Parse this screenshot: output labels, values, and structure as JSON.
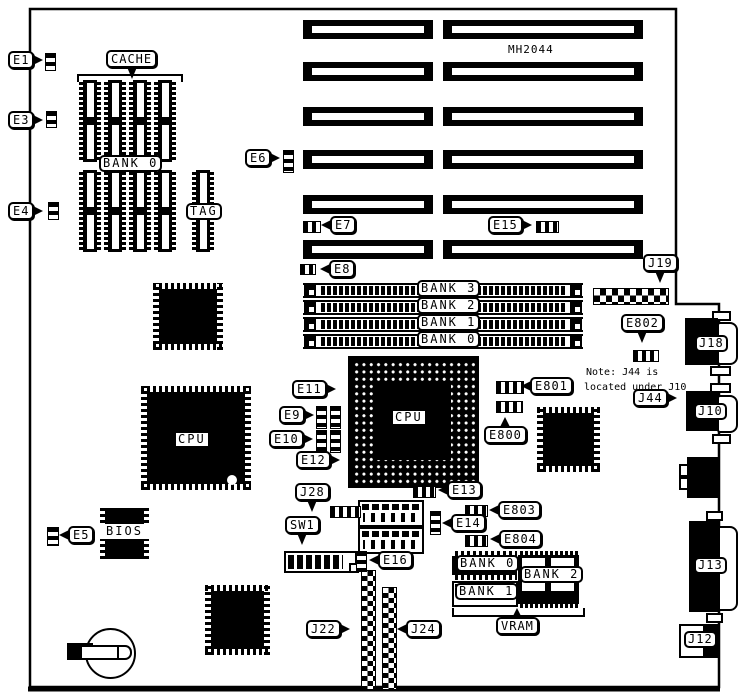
{
  "title": "MH2044 motherboard jumper and connector location diagram",
  "board_text": {
    "model": "MH2044",
    "note1": "Note:  J44 is",
    "note2": "located under J10"
  },
  "callouts": {
    "e1": "E1",
    "e3": "E3",
    "e4": "E4",
    "e5": "E5",
    "e6": "E6",
    "e7": "E7",
    "e8": "E8",
    "e9": "E9",
    "e10": "E10",
    "e11": "E11",
    "e12": "E12",
    "e13": "E13",
    "e14": "E14",
    "e15": "E15",
    "e16": "E16",
    "e800": "E800",
    "e801": "E801",
    "e802": "E802",
    "e803": "E803",
    "e804": "E804",
    "j19": "J19",
    "j22": "J22",
    "j24": "J24",
    "j28": "J28",
    "j44": "J44",
    "sw1": "SW1",
    "cache": "CACHE",
    "vram": "VRAM"
  },
  "chip_labels": {
    "cache_bank0": "BANK 0",
    "tag": "TAG",
    "cpu_socket": "CPU",
    "cpu_chip": "CPU",
    "bios": "BIOS",
    "simm_bank3": "BANK 3",
    "simm_bank2": "BANK 2",
    "simm_bank1": "BANK 1",
    "simm_bank0": "BANK 0",
    "vram_bank0": "BANK 0",
    "vram_bank1": "BANK 1",
    "vram_bank2": "BANK 2"
  },
  "ports": {
    "j18": "J18",
    "j10": "J10",
    "j13": "J13",
    "j12": "J12"
  },
  "colors": {
    "ink": "#000000",
    "paper": "#ffffff"
  }
}
